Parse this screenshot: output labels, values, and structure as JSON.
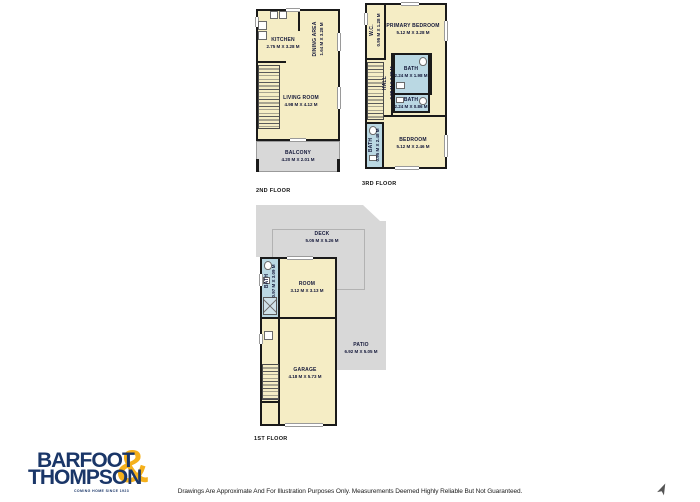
{
  "page": {
    "disclaimer": "Drawings Are Approximate And For Illustration Purposes Only. Measurements Deemed Highly Reliable But Not Guaranteed."
  },
  "logo": {
    "word1": "BARFOOT",
    "word2": "THOMPSON",
    "ampersand": "&",
    "tagline": "COMING HOME SINCE 1923"
  },
  "colors": {
    "room_fill": "#f5edc5",
    "wet_fill": "#bad8e3",
    "outdoor_fill": "#d8d8d8",
    "wall": "#1a1a1a",
    "navy": "#1a3668",
    "gold": "#f5b01b"
  },
  "floors": {
    "second": {
      "label": "2ND FLOOR",
      "kitchen": {
        "name": "KITCHEN",
        "dims": "2.75 M X 3.28 M"
      },
      "dining": {
        "name": "DINING AREA",
        "dims": "1.64 M X 3.28 M"
      },
      "living": {
        "name": "LIVING ROOM",
        "dims": "4.98 M X 4.12 M"
      },
      "balcony": {
        "name": "BALCONY",
        "dims": "4.20 M X 2.01 M"
      }
    },
    "third": {
      "label": "3RD FLOOR",
      "wc": {
        "name": "W.C.",
        "dims": "0.95 M X 1.28 M"
      },
      "primary_bedroom": {
        "name": "PRIMARY BEDROOM",
        "dims": "5.12 M X 3.28 M"
      },
      "bath_main": {
        "name": "BATH",
        "dims": "2.24 M X 1.98 M"
      },
      "hall": {
        "name": "HALL",
        "dims": "0.88 M X 3.08 M"
      },
      "bath_small": {
        "name": "BATH",
        "dims": "2.24 M X 0.86 M"
      },
      "bath_ensuite": {
        "name": "BATH",
        "dims": "0.95 M X 2.48 M"
      },
      "bedroom": {
        "name": "BEDROOM",
        "dims": "5.12 M X 2.46 M"
      }
    },
    "first": {
      "label": "1ST FLOOR",
      "deck": {
        "name": "DECK",
        "dims": "5.05 M X 5.26 M"
      },
      "room": {
        "name": "ROOM",
        "dims": "3.12 M X 3.13 M"
      },
      "bath": {
        "name": "BATH",
        "dims": "0.97 M X 3.09 M"
      },
      "garage": {
        "name": "GARAGE",
        "dims": "4.18 M X 5.73 M"
      },
      "patio": {
        "name": "PATIO",
        "dims": "6.92 M X 5.05 M"
      }
    }
  }
}
